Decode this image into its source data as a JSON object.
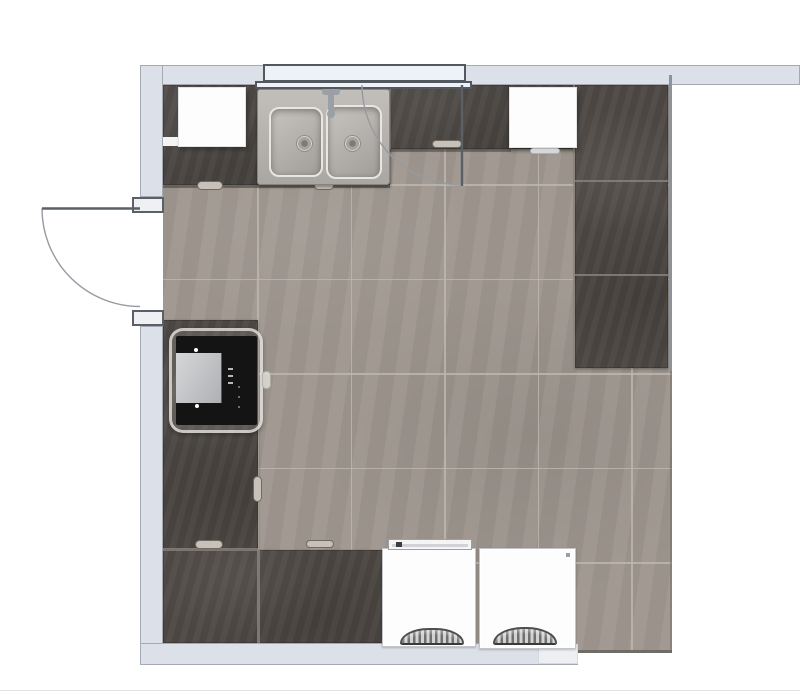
{
  "canvas": {
    "w": 800,
    "h": 694,
    "background": "#ffffff"
  },
  "palette": {
    "wall_fill": "#dbe0e9",
    "wall_edge": "#a6abb3",
    "right_wall": "#8d939b",
    "floor": "#9f978f",
    "floor_seam": "#bdb6ad",
    "counter": "#4f4a46",
    "counter_seam": "#8b857f",
    "window_fill": "#eef1f5",
    "window_edge": "#525860",
    "cabinet_white": "#fdfdfd",
    "appliance_white": "#fdfdfd",
    "oven_black": "#141414",
    "sink_steel": "#b7b3ae",
    "door_panel_stroke": "#5a6066",
    "door_arc_stroke": "#969ba1"
  },
  "walls": {
    "top": {
      "x": 140,
      "y": 65,
      "w": 660,
      "h": 20
    },
    "left_upper": {
      "x": 140,
      "y": 65,
      "w": 23,
      "h": 132
    },
    "left_lower": {
      "x": 140,
      "y": 326,
      "w": 23,
      "h": 339
    },
    "bottom": {
      "x": 140,
      "y": 643,
      "w": 438,
      "h": 22
    },
    "right_line": {
      "x": 669,
      "y": 75,
      "w": 3,
      "h": 296
    }
  },
  "window": {
    "upper": {
      "x": 263,
      "y": 64,
      "w": 203,
      "h": 18
    },
    "lower": {
      "x": 255,
      "y": 81,
      "w": 217,
      "h": 8
    }
  },
  "doors": {
    "left": {
      "jamb_top": {
        "x": 132,
        "y": 197,
        "w": 32,
        "h": 16
      },
      "jamb_bottom": {
        "x": 132,
        "y": 310,
        "w": 32,
        "h": 16
      },
      "panel_path": "M 42 208.5 L 140 208.5",
      "arc_path": "M 42 208.5 A 98 98 0 0 0 140 306.5"
    },
    "top": {
      "panel_path": "M 462 85 L 462 186",
      "arc_path": "M 362 85 A 100 100 0 0 0 462 185"
    }
  },
  "floor": {
    "rect": {
      "x": 163,
      "y": 85,
      "w": 509,
      "h": 568
    },
    "seams_x": [
      94,
      187.5,
      281,
      374.5,
      468
    ],
    "seams_y": [
      99,
      193.5,
      288,
      382.5,
      477,
      571.5
    ],
    "edge_bottom_right": {
      "x": 578,
      "y": 650,
      "w": 94,
      "h": 3,
      "f": "#6f6b67"
    },
    "edge_right": {
      "x": 670,
      "y": 371,
      "w": 2,
      "h": 282,
      "f": "rgba(110,105,100,0.5)"
    }
  },
  "counters": {
    "blocks": [
      {
        "name": "counter-top-left",
        "x": 163,
        "y": 85,
        "w": 97,
        "h": 100
      },
      {
        "name": "counter-sink-base",
        "x": 260,
        "y": 85,
        "w": 130,
        "h": 100
      },
      {
        "name": "counter-top-strip",
        "x": 390,
        "y": 85,
        "w": 121,
        "h": 64
      },
      {
        "name": "counter-top-strip-2",
        "x": 509,
        "y": 85,
        "w": 68,
        "h": 64
      },
      {
        "name": "counter-right-column",
        "x": 575,
        "y": 85,
        "w": 93,
        "h": 283
      },
      {
        "name": "counter-left-column",
        "x": 163,
        "y": 320,
        "w": 95,
        "h": 230
      },
      {
        "name": "counter-bottom-row",
        "x": 163,
        "y": 550,
        "w": 224,
        "h": 93
      }
    ],
    "seams": [
      {
        "x": 259,
        "y": 85,
        "w": 2,
        "h": 100
      },
      {
        "x": 389,
        "y": 85,
        "w": 2,
        "h": 64
      },
      {
        "x": 575,
        "y": 180,
        "w": 93,
        "h": 2
      },
      {
        "x": 575,
        "y": 274,
        "w": 93,
        "h": 2
      },
      {
        "x": 573,
        "y": 85,
        "w": 2,
        "h": 283
      },
      {
        "x": 163,
        "y": 548,
        "w": 95,
        "h": 3
      },
      {
        "x": 257,
        "y": 550,
        "w": 3,
        "h": 93
      }
    ],
    "shadows": [
      {
        "x": 163,
        "y": 185,
        "w": 227,
        "h": 3,
        "f": "rgba(40,38,36,0.45)"
      },
      {
        "x": 390,
        "y": 149,
        "w": 121,
        "h": 3,
        "f": "rgba(40,38,36,0.40)"
      }
    ],
    "handles": [
      {
        "x": 197,
        "y": 181,
        "w": 26,
        "h": 9
      },
      {
        "x": 314,
        "y": 181,
        "w": 20,
        "h": 9
      },
      {
        "x": 432,
        "y": 140,
        "w": 30,
        "h": 8
      },
      {
        "x": 195,
        "y": 540,
        "w": 28,
        "h": 9
      },
      {
        "x": 306,
        "y": 540,
        "w": 28,
        "h": 8
      },
      {
        "x": 253,
        "y": 476,
        "w": 9,
        "h": 26
      }
    ],
    "dark_bar": {
      "x": 291,
      "y": 89,
      "w": 66,
      "h": 9
    },
    "white_notch": {
      "x": 163,
      "y": 137,
      "w": 16,
      "h": 9
    }
  },
  "cabinets": {
    "top_left": {
      "x": 178,
      "y": 87,
      "w": 68,
      "h": 60
    },
    "top_right": {
      "x": 509,
      "y": 87,
      "w": 68,
      "h": 61
    },
    "top_right_handle": {
      "x": 530,
      "y": 148,
      "w": 30,
      "h": 6
    }
  },
  "sink": {
    "outer": {
      "x": 257,
      "y": 89,
      "w": 133,
      "h": 96
    },
    "basin_left": {
      "x": 269,
      "y": 107,
      "w": 54,
      "h": 70
    },
    "basin_right": {
      "x": 326,
      "y": 105,
      "w": 56,
      "h": 74
    },
    "drain_left": {
      "x": 296,
      "y": 135,
      "w": 17,
      "h": 17
    },
    "drain_right": {
      "x": 344,
      "y": 135,
      "w": 17,
      "h": 17
    },
    "faucet_base": {
      "x": 322,
      "y": 88,
      "w": 18,
      "h": 7
    },
    "faucet_stem": {
      "x": 328,
      "y": 92,
      "w": 6,
      "h": 20
    },
    "faucet_knob": {
      "x": 327,
      "y": 110,
      "w": 8,
      "h": 8
    }
  },
  "oven": {
    "surround": {
      "x": 169,
      "y": 328,
      "w": 94,
      "h": 105
    },
    "body": {
      "x": 176,
      "y": 336,
      "w": 81,
      "h": 89
    },
    "panel": {
      "x": 176,
      "y": 353,
      "w": 46,
      "h": 50
    },
    "dot_top": {
      "x": 194,
      "y": 348,
      "w": 4,
      "h": 4
    },
    "dot_bottom": {
      "x": 195,
      "y": 404,
      "w": 4,
      "h": 4
    },
    "dash_1": {
      "x": 228,
      "y": 368,
      "w": 5,
      "h": 2
    },
    "dash_2": {
      "x": 228,
      "y": 375,
      "w": 5,
      "h": 2
    },
    "dash_3": {
      "x": 228,
      "y": 382,
      "w": 5,
      "h": 2
    },
    "mark_1": {
      "x": 238,
      "y": 386,
      "w": 2,
      "h": 2
    },
    "mark_2": {
      "x": 238,
      "y": 396,
      "w": 2,
      "h": 2
    },
    "mark_3": {
      "x": 238,
      "y": 406,
      "w": 2,
      "h": 2
    },
    "tab": {
      "x": 262,
      "y": 371,
      "w": 9,
      "h": 18
    }
  },
  "appliances": {
    "left": {
      "body": {
        "x": 382,
        "y": 548,
        "w": 94,
        "h": 99
      },
      "strip": {
        "x": 388,
        "y": 539,
        "w": 84,
        "h": 11
      },
      "strip_dot": {
        "x": 396,
        "y": 542,
        "w": 6,
        "h": 5
      },
      "strip_line": {
        "x": 392,
        "y": 544,
        "w": 76,
        "h": 3
      },
      "grille": {
        "x": 400,
        "y": 628,
        "w": 64,
        "h": 17
      }
    },
    "right": {
      "body": {
        "x": 479,
        "y": 548,
        "w": 97,
        "h": 101
      },
      "corner_mark": {
        "x": 566,
        "y": 553,
        "w": 4,
        "h": 4
      },
      "grille": {
        "x": 493,
        "y": 627,
        "w": 64,
        "h": 18
      },
      "base_patch": {
        "x": 538,
        "y": 644,
        "w": 40,
        "h": 20
      }
    }
  },
  "misc": {
    "canvas_edge": {
      "x": 0,
      "y": 690,
      "w": 800,
      "h": 1
    }
  }
}
